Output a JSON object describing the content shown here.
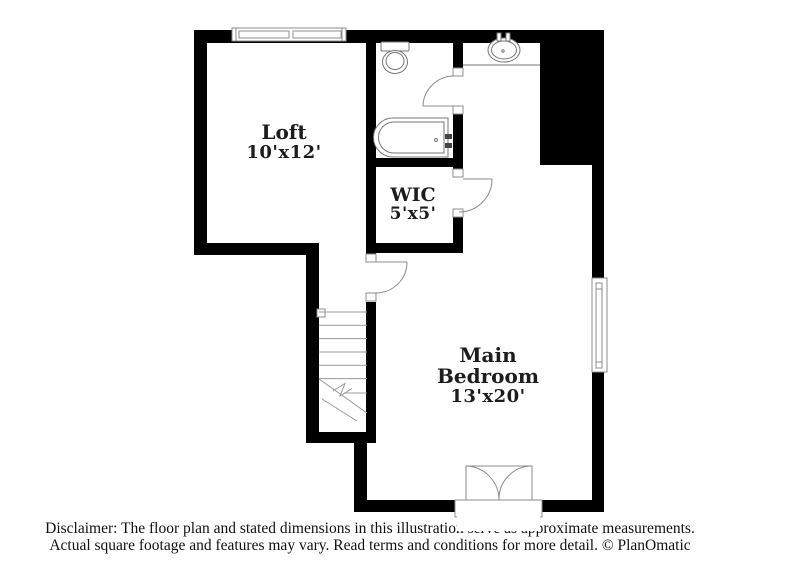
{
  "plan": {
    "type": "floor-plan",
    "rooms": [
      {
        "id": "loft",
        "name_lines": [
          "Loft"
        ],
        "dimensions": "10'x12'"
      },
      {
        "id": "wic",
        "name_lines": [
          "WIC"
        ],
        "dimensions": "5'x5'"
      },
      {
        "id": "main-bedroom",
        "name_lines": [
          "Main",
          "Bedroom"
        ],
        "dimensions": "13'x20'"
      }
    ],
    "fixtures": [
      "toilet-icon",
      "sink-icon",
      "bathtub-icon",
      "vanity-counter",
      "stairs-icon",
      "door-swing-icon",
      "french-doors-icon",
      "window-icon"
    ],
    "colors": {
      "background": "#ffffff",
      "wall": "#000000",
      "fixture_line": "#8c8c8c",
      "text": "#1c1c1c"
    }
  },
  "disclaimer": {
    "line1": "Disclaimer: The floor plan and stated dimensions in this illustration serve as approximate measurements.",
    "line2": "Actual square footage and features may vary. Read terms and conditions for more detail. © PlanOmatic"
  }
}
